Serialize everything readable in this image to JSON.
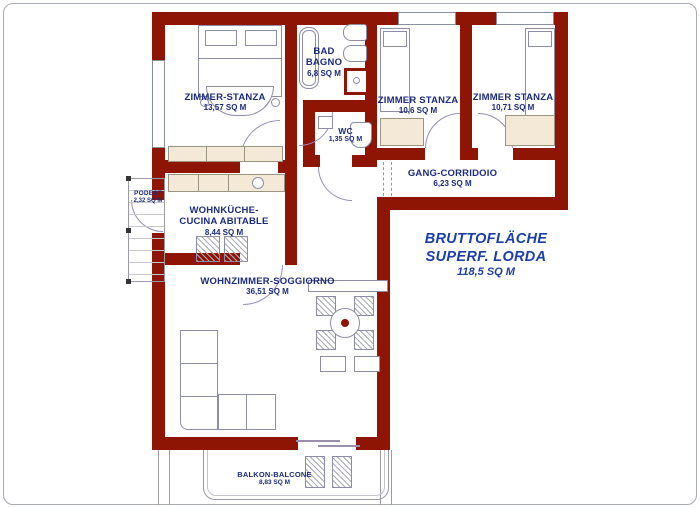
{
  "plan_type": "apartment-floor-plan",
  "colors": {
    "wall": "#8e1404",
    "room_label": "#1c2b80",
    "annotation": "#1c3fa6",
    "furniture_fill": "#f3e9d6",
    "fixture_outline": "#8d8da8",
    "background": "#ffffff"
  },
  "rooms": [
    {
      "id": "bedroom-1",
      "name1": "ZIMMER-STANZA",
      "area": "13,57 SQ M"
    },
    {
      "id": "bathroom",
      "name1": "BAD",
      "name2": "BAGNO",
      "area": "6,8 SQ M"
    },
    {
      "id": "bedroom-2",
      "name1": "ZIMMER STANZA",
      "area": "10,6 SQ M"
    },
    {
      "id": "bedroom-3",
      "name1": "ZIMMER STANZA",
      "area": "10,71 SQ M"
    },
    {
      "id": "wc",
      "name1": "WC",
      "area": "1,35 SQ M"
    },
    {
      "id": "corridor",
      "name1": "GANG-CORRIDOIO",
      "area": "6,23 SQ M"
    },
    {
      "id": "podest",
      "name1": "PODEST",
      "area": "2,32 SQ M"
    },
    {
      "id": "kitchen",
      "name1": "WOHNKÜCHE-",
      "name2": "CUCINA ABITABLE",
      "area": "8,44 SQ M"
    },
    {
      "id": "living",
      "name1": "WOHNZIMMER-SOGGIORNO",
      "area": "36,51 SQ M"
    },
    {
      "id": "balcony",
      "name1": "BALKON-BALCONE",
      "area": "8,83 SQ M"
    }
  ],
  "annotation": {
    "line1": "BRUTTOFLÄCHE",
    "line2": "SUPERF. LORDA",
    "area": "118,5 SQ M"
  }
}
